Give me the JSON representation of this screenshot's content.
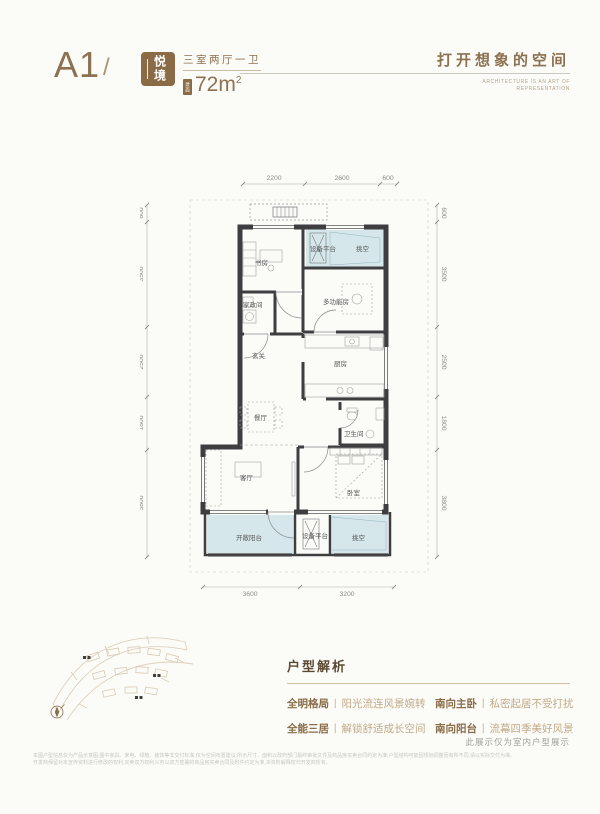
{
  "header": {
    "plan_code": "A1",
    "slash": "/",
    "badge": "悦境",
    "layout": "三室两厅一卫",
    "area_tag": "建面",
    "area": "72m",
    "area_sup": "2",
    "slogan": "打开想象的空间",
    "slogan_sub1": "ARCHITECTURE IS AN ART OF",
    "slogan_sub2": "REPRESENTATION"
  },
  "floorplan": {
    "rooms": [
      "书房",
      "设备平台",
      "挑空",
      "家政间",
      "多功能房",
      "玄关",
      "厨房",
      "餐厅",
      "卫生间",
      "客厅",
      "卧室",
      "开敞阳台",
      "设备平台",
      "挑空"
    ],
    "dims_top": [
      "2200",
      "2600",
      "600"
    ],
    "dims_bottom": [
      "3600",
      "3200"
    ],
    "dims_left": [
      "600",
      "3500",
      "2500",
      "1800",
      "3800"
    ],
    "dims_right": [
      "600",
      "3500",
      "2500",
      "1800",
      "3800"
    ]
  },
  "analysis": {
    "title": "户型解析",
    "separator": "丨",
    "items": [
      {
        "label": "全明格局",
        "desc": "阳光流连风景婉转"
      },
      {
        "label": "全能三居",
        "desc": "解锁舒适成长空间"
      },
      {
        "label": "南向主卧",
        "desc": "私密起居不受打扰"
      },
      {
        "label": "南向阳台",
        "desc": "流幕四季美好风景"
      }
    ]
  },
  "footer": {
    "note": "此展示仅为室内户型展示",
    "disclaimer1": "本图户型信息仅为产品示意图,图中家具、家电、绿植、装饰等非交付标准,仅为空间布置建议;所示尺寸、面积以政府部门最终审批文件及商品房买卖合同约定为准;户型结构可能因规划调整而有所不同,请以实际交付为准。",
    "disclaimer2": "开发商保留对本宣传资料进行修改的权利,买卖双方权利义务以双方签署的商品房买卖合同及附件约定为准,本资料解释权归开发商所有。"
  },
  "colors": {
    "accent_brown": "#8a6b46",
    "wall": "#3e3e40",
    "void_fill": "#d5e7ea",
    "dim_gray": "#8c8c88"
  }
}
